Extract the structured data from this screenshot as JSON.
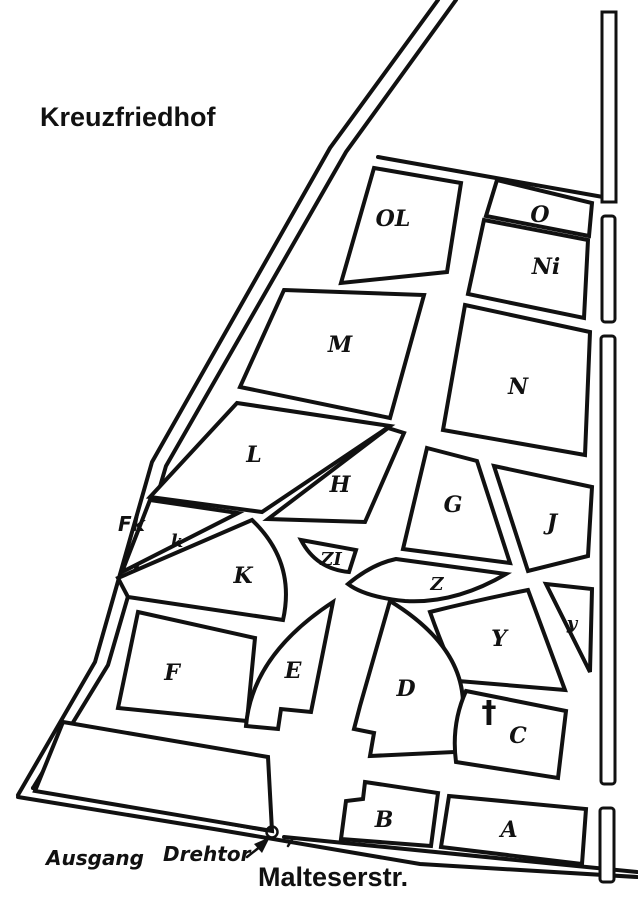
{
  "title": "Kreuzfriedhof",
  "street_label": "Malteserstr.",
  "exit_label": "Ausgang",
  "gate_label": "Drehtor",
  "chapel_label": "Fk",
  "cross_symbol": "†",
  "ink_color": "#111111",
  "paper_color": "#ffffff",
  "sections": [
    {
      "id": "OL",
      "label": "OL",
      "x": 393,
      "y": 226
    },
    {
      "id": "O",
      "label": "O",
      "x": 540,
      "y": 222
    },
    {
      "id": "Ni",
      "label": "Ni",
      "x": 546,
      "y": 274
    },
    {
      "id": "M",
      "label": "M",
      "x": 340,
      "y": 352
    },
    {
      "id": "N",
      "label": "N",
      "x": 518,
      "y": 394
    },
    {
      "id": "L",
      "label": "L",
      "x": 254,
      "y": 462
    },
    {
      "id": "H",
      "label": "H",
      "x": 340,
      "y": 492
    },
    {
      "id": "G",
      "label": "G",
      "x": 453,
      "y": 512
    },
    {
      "id": "J",
      "label": "J",
      "x": 552,
      "y": 530
    },
    {
      "id": "k",
      "label": "k",
      "x": 177,
      "y": 547
    },
    {
      "id": "K",
      "label": "K",
      "x": 243,
      "y": 583
    },
    {
      "id": "ZI",
      "label": "ZI",
      "x": 331,
      "y": 565
    },
    {
      "id": "Z",
      "label": "Z",
      "x": 437,
      "y": 590
    },
    {
      "id": "y",
      "label": "y",
      "x": 572,
      "y": 629
    },
    {
      "id": "Y",
      "label": "Y",
      "x": 499,
      "y": 646
    },
    {
      "id": "F",
      "label": "F",
      "x": 172,
      "y": 680
    },
    {
      "id": "E",
      "label": "E",
      "x": 293,
      "y": 678
    },
    {
      "id": "D",
      "label": "D",
      "x": 406,
      "y": 696
    },
    {
      "id": "C",
      "label": "C",
      "x": 518,
      "y": 743
    },
    {
      "id": "B",
      "label": "B",
      "x": 384,
      "y": 827
    },
    {
      "id": "A",
      "label": "A",
      "x": 509,
      "y": 837
    }
  ]
}
